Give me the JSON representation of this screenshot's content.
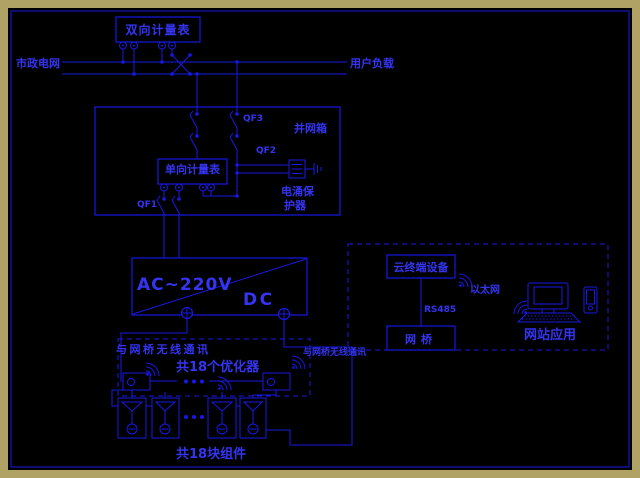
{
  "colors": {
    "canvas_background": "#000000",
    "outer_frame": "#b0a164",
    "line_blue": "#1818e6",
    "text_blue": "#3434f2"
  },
  "labels": {
    "municipal_grid": "市政电网",
    "user_load": "用户负载",
    "bidirectional_meter": "双向计量表",
    "grid_tie_box": "并网箱",
    "qf3": "QF3",
    "qf2": "QF2",
    "qf1": "QF1",
    "unidirectional_meter": "单向计量表",
    "spd_line1": "电涌保",
    "spd_line2": "护器",
    "inverter_ac": "AC~220V",
    "inverter_dc": "DC",
    "wireless_left": "与网桥无线通讯",
    "wireless_right": "与网桥无线通讯",
    "optimizer_count": "共18个优化器",
    "module_count": "共18块组件",
    "cloud_terminal": "云终端设备",
    "rs485": "RS485",
    "bridge": "网桥",
    "ethernet": "以太网",
    "web_app": "网站应用"
  }
}
